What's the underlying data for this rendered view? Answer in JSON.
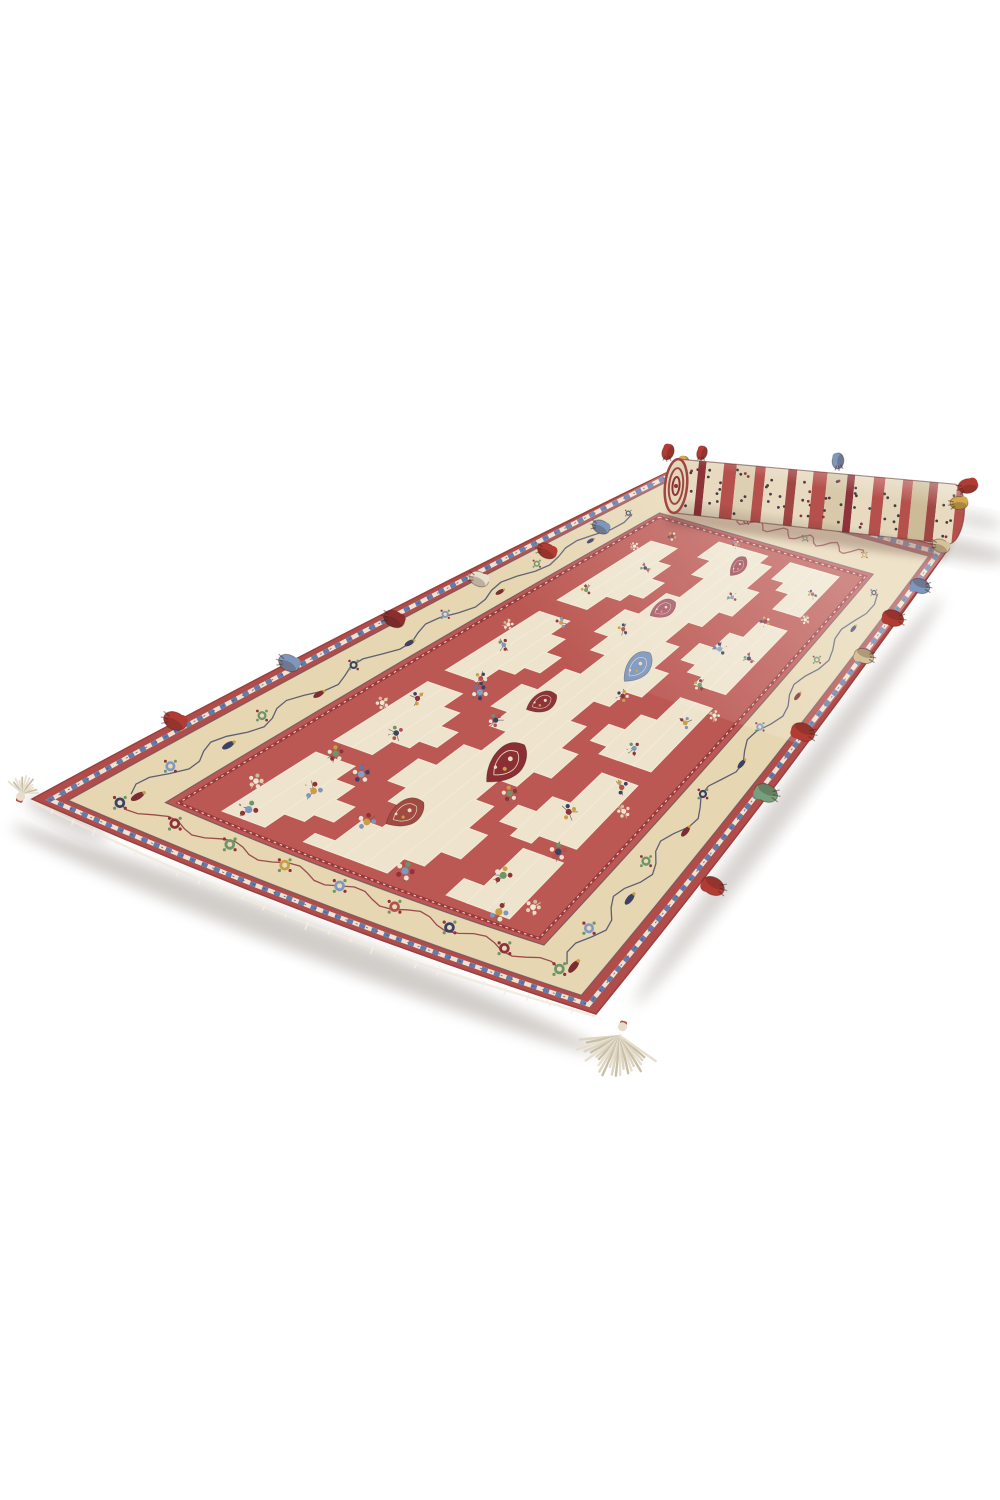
{
  "image": {
    "width": 1000,
    "height": 1500,
    "background": "#ffffff",
    "alt": "Hand-woven red and cream oriental runner rug with stepped kilim pattern, multicolored edge tassels, partially rolled at the far end, on a white background"
  },
  "palette": {
    "red_outer": "#b04c4a",
    "red_band": "#bb5853",
    "red_dark": "#8e3339",
    "maroon": "#7c2d33",
    "cream_border": "#e6d6b2",
    "cream_field": "#eee4cd",
    "cream_pale": "#f2ead9",
    "navy": "#3d4263",
    "dark": "#4a3f46",
    "steel": "#85a0c6",
    "green": "#6e9467",
    "gold": "#c99f45",
    "white_fringe": "#f3efe6",
    "shadow": "#8d8379"
  },
  "rug": {
    "quad": {
      "far_left": [
        666,
        473
      ],
      "far_right": [
        948,
        549
      ],
      "near_left": [
        32,
        799
      ],
      "near_right": [
        596,
        1014
      ]
    },
    "edge_bows": {
      "far": 0,
      "right": 10,
      "bottom": 16,
      "left": 8
    },
    "bands": {
      "edge_stroke": "#9c3f3e",
      "braid": {
        "u": 0.011,
        "v": 0.02,
        "white": "#f2ead9",
        "blue": "#5f7cab",
        "dark": "#44507a"
      },
      "cream_outer": {
        "u": 0.022,
        "v": 0.04
      },
      "cream_inner": {
        "u": 0.0825,
        "v": 0.15
      },
      "guard": {
        "u": 0.0908,
        "v": 0.165,
        "color": "#993a3e"
      },
      "edge_line_color": "#6b5560"
    },
    "field": {
      "u0": 0.107,
      "u1": 0.893,
      "v0": 0.195,
      "v1": 0.805,
      "cell_outline": "#f2ead9",
      "grid_rows": [
        "RRRRRRRRRRRRRRRRRRRRRRRRRRRRRRRRRRRRRRRRRRRR",
        "RR.........RR.........RR.........RR.........",
        "RR.........RR.........RR.........RR.........",
        "RRRR.....RRRRRR.....RRRRRR.....RRRRRR.....RR",
        "RRRRRR..RRRRRRRRR..RRRRRRRRR..RRRRRRRRR..RRR",
        "..RRRRRRRR...RRRRRRRR...RRRRRRRR...RRRRRRRR.",
        "....RRR........RRR........RRR........RRR....",
        "............................................",
        "............................................",
        "R........RRR........RRR........RRR........RR",
        "RRRR...RRRRRRRR...RRRRRRRR...RRRRRRRR...RRRR",
        "..RRRRRRRRR..RRRRRRRRR..RRRRRRRRR..RRRRRRRRR",
        "...RRRRRR.....RRRRRR.....RRRRRR.....RRRRRR..",
        ".....RR........RR........RR........RR.......",
        ".....RR........RR........RR........RR.......",
        "RRRRRRRRRRRRRRRRRRRRRRRRRRRRRRRRRRRRRRRRRRRR"
      ]
    },
    "botehs": [
      [
        0.14,
        0.5,
        0.85,
        "#9c4450",
        -12
      ],
      [
        0.26,
        0.455,
        0.9,
        "#a85a68",
        10
      ],
      [
        0.38,
        0.545,
        1.05,
        "#7e97bd",
        -8
      ],
      [
        0.5,
        0.455,
        0.9,
        "#8e3339",
        12
      ],
      [
        0.63,
        0.52,
        1.25,
        "#8b2f35",
        -5
      ],
      [
        0.78,
        0.465,
        0.95,
        "#a04a42",
        8
      ]
    ],
    "cluster_palettes": [
      [
        "#8e3339",
        "#c99f45",
        "#3d4263"
      ],
      [
        "#3d4263",
        "#b5504d",
        "#6e9467"
      ],
      [
        "#6e9467",
        "#8e3339",
        "#c99f45"
      ],
      [
        "#c99f45",
        "#7e97bd",
        "#8e3339"
      ],
      [
        "#7e97bd",
        "#8e3339",
        "#6e9467"
      ],
      [
        "#b5504d",
        "#3d4263",
        "#c99f45"
      ],
      [
        "#85a0c6",
        "#3d4263",
        "#5b79ad"
      ],
      [
        "#f0e7d2",
        "#e2d3b4",
        "#cdbd9c"
      ]
    ],
    "clusters": [
      [
        0.12,
        0.26,
        0,
        1
      ],
      [
        0.195,
        0.305,
        1,
        1
      ],
      [
        0.27,
        0.255,
        2,
        1
      ],
      [
        0.345,
        0.3,
        3,
        1
      ],
      [
        0.42,
        0.26,
        4,
        1
      ],
      [
        0.495,
        0.305,
        5,
        1
      ],
      [
        0.57,
        0.255,
        0,
        1
      ],
      [
        0.645,
        0.3,
        1,
        1
      ],
      [
        0.72,
        0.26,
        2,
        1.05
      ],
      [
        0.8,
        0.305,
        3,
        1.1
      ],
      [
        0.875,
        0.26,
        4,
        1.1
      ],
      [
        0.15,
        0.745,
        5,
        1
      ],
      [
        0.225,
        0.7,
        0,
        1
      ],
      [
        0.3,
        0.745,
        1,
        1
      ],
      [
        0.375,
        0.7,
        2,
        1
      ],
      [
        0.45,
        0.745,
        3,
        1
      ],
      [
        0.525,
        0.7,
        4,
        1
      ],
      [
        0.6,
        0.745,
        5,
        1
      ],
      [
        0.675,
        0.7,
        0,
        1.05
      ],
      [
        0.75,
        0.745,
        1,
        1.1
      ],
      [
        0.825,
        0.7,
        2,
        1.1
      ],
      [
        0.89,
        0.745,
        3,
        1.1
      ],
      [
        0.1,
        0.43,
        3,
        0.9
      ],
      [
        0.2,
        0.57,
        4,
        1
      ],
      [
        0.32,
        0.43,
        5,
        1
      ],
      [
        0.44,
        0.58,
        0,
        1
      ],
      [
        0.56,
        0.42,
        1,
        1
      ],
      [
        0.68,
        0.58,
        2,
        1.05
      ],
      [
        0.82,
        0.43,
        3,
        1.1
      ],
      [
        0.88,
        0.56,
        4,
        1.1
      ],
      [
        0.52,
        0.335,
        6,
        1.2
      ],
      [
        0.3,
        0.665,
        6,
        1.2
      ],
      [
        0.74,
        0.335,
        6,
        1.1
      ],
      [
        0.16,
        0.214,
        7,
        0.9
      ],
      [
        0.38,
        0.214,
        7,
        0.9
      ],
      [
        0.6,
        0.214,
        7,
        0.9
      ],
      [
        0.82,
        0.214,
        7,
        0.9
      ],
      [
        0.2,
        0.786,
        7,
        0.9
      ],
      [
        0.42,
        0.786,
        7,
        0.9
      ],
      [
        0.64,
        0.786,
        7,
        0.9
      ],
      [
        0.86,
        0.786,
        7,
        0.9
      ]
    ],
    "border": {
      "rosette_colors": [
        "#3d4263",
        "#8e3339",
        "#6e9467",
        "#c99f45",
        "#7f99c0",
        "#b5504d"
      ],
      "left": {
        "v": 0.095,
        "count": 12,
        "from": 0.1,
        "to": 0.925,
        "vine": "#474a68",
        "trees": true
      },
      "right": {
        "v": 0.905,
        "count": 12,
        "from": 0.115,
        "to": 0.935,
        "vine": "#474a68",
        "trees": true
      },
      "near": {
        "u": 0.948,
        "count": 9,
        "from": 0.1,
        "to": 0.9,
        "vine": "#8e3339",
        "trees": false
      },
      "far": {
        "u": 0.052,
        "count": 4,
        "from": 0.18,
        "to": 0.78,
        "vine": "#8e3339",
        "trees": false
      }
    }
  },
  "roll": {
    "a1": [
      676,
      486
    ],
    "a2": [
      952,
      514
    ],
    "r1": 27,
    "r2": 30,
    "cap_fill": "#e3d5b8",
    "cap_ring": "#a04643",
    "cap_ring2": "#8e3339",
    "stripes": {
      "widths": [
        12,
        16,
        6,
        14,
        10,
        15,
        8,
        18,
        7,
        13,
        11,
        16,
        6,
        15,
        9,
        14,
        8,
        13,
        7,
        15,
        10
      ],
      "colors": [
        "#b5504d",
        "#e7dac1",
        "#8e3339",
        "#e7dac1",
        "#b5504d",
        "#ddcfb2",
        "#b5504d",
        "#e7dac1",
        "#a04643",
        "#e7dac1",
        "#b5504d",
        "#d8c9ab",
        "#8e3339",
        "#e7dac1",
        "#b5504d",
        "#e2d5ba",
        "#b5504d",
        "#cdbb97",
        "#a04643",
        "#e7dac1",
        "#b5504d"
      ],
      "speckle": "#473c42",
      "speckle2": "#8e3339"
    },
    "contact_shadow": "#6a4038"
  },
  "tassels": {
    "colors": {
      "red": "#b23b33",
      "darkred": "#8c2e2e",
      "blue": "#7e97bd",
      "green": "#74a07b",
      "gold": "#d2a94e",
      "cream": "#e9e0cc",
      "tan": "#d6c29a",
      "creambig": "#ddd3c0"
    },
    "items": [
      [
        22,
        793,
        "cream",
        "fan",
        200,
        13,
        0
      ],
      [
        175,
        721,
        "red",
        "blob",
        28,
        12,
        0
      ],
      [
        289,
        663,
        "blue",
        "blob",
        28,
        11,
        0
      ],
      [
        394,
        619,
        "darkred",
        "blob",
        28,
        11,
        0
      ],
      [
        479,
        579,
        "cream",
        "blob",
        28,
        10,
        0
      ],
      [
        547,
        551,
        "red",
        "blob",
        28,
        10,
        0
      ],
      [
        601,
        527,
        "blue",
        "blob",
        28,
        9,
        0
      ],
      [
        668,
        452,
        "red",
        "blob",
        -70,
        8,
        1
      ],
      [
        683,
        464,
        "gold",
        "blob",
        -70,
        8,
        1
      ],
      [
        702,
        453,
        "red",
        "blob",
        -70,
        7,
        1
      ],
      [
        838,
        461,
        "blue",
        "blob",
        -85,
        8,
        1
      ],
      [
        968,
        486,
        "red",
        "blob",
        -10,
        10,
        0
      ],
      [
        959,
        503,
        "gold",
        "blob",
        0,
        9,
        0
      ],
      [
        941,
        546,
        "tan",
        "blob",
        25,
        9,
        0
      ],
      [
        920,
        586,
        "blue",
        "blob",
        200,
        10,
        0
      ],
      [
        893,
        618,
        "red",
        "blob",
        200,
        11,
        0
      ],
      [
        864,
        656,
        "tan",
        "blob",
        200,
        10,
        0
      ],
      [
        803,
        732,
        "red",
        "blob",
        205,
        12,
        0
      ],
      [
        766,
        793,
        "green",
        "blob",
        205,
        12,
        0
      ],
      [
        713,
        886,
        "red",
        "blob",
        210,
        12,
        0
      ],
      [
        620,
        1036,
        "creambig",
        "fanbig",
        15,
        34,
        0
      ]
    ]
  },
  "shadows": {
    "color": "#8d8379",
    "spots": [
      [
        306,
        939,
        315,
        16,
        21,
        0.4
      ],
      [
        788,
        801,
        255,
        13,
        -53,
        0.34
      ],
      [
        952,
        548,
        58,
        11,
        10,
        0.35
      ],
      [
        66,
        818,
        46,
        9,
        26,
        0.38
      ],
      [
        977,
        521,
        26,
        8,
        10,
        0.28
      ]
    ]
  },
  "haze": {
    "from": [
      797,
      519
    ],
    "to": [
      585,
      689
    ],
    "opacity": 0.28
  }
}
